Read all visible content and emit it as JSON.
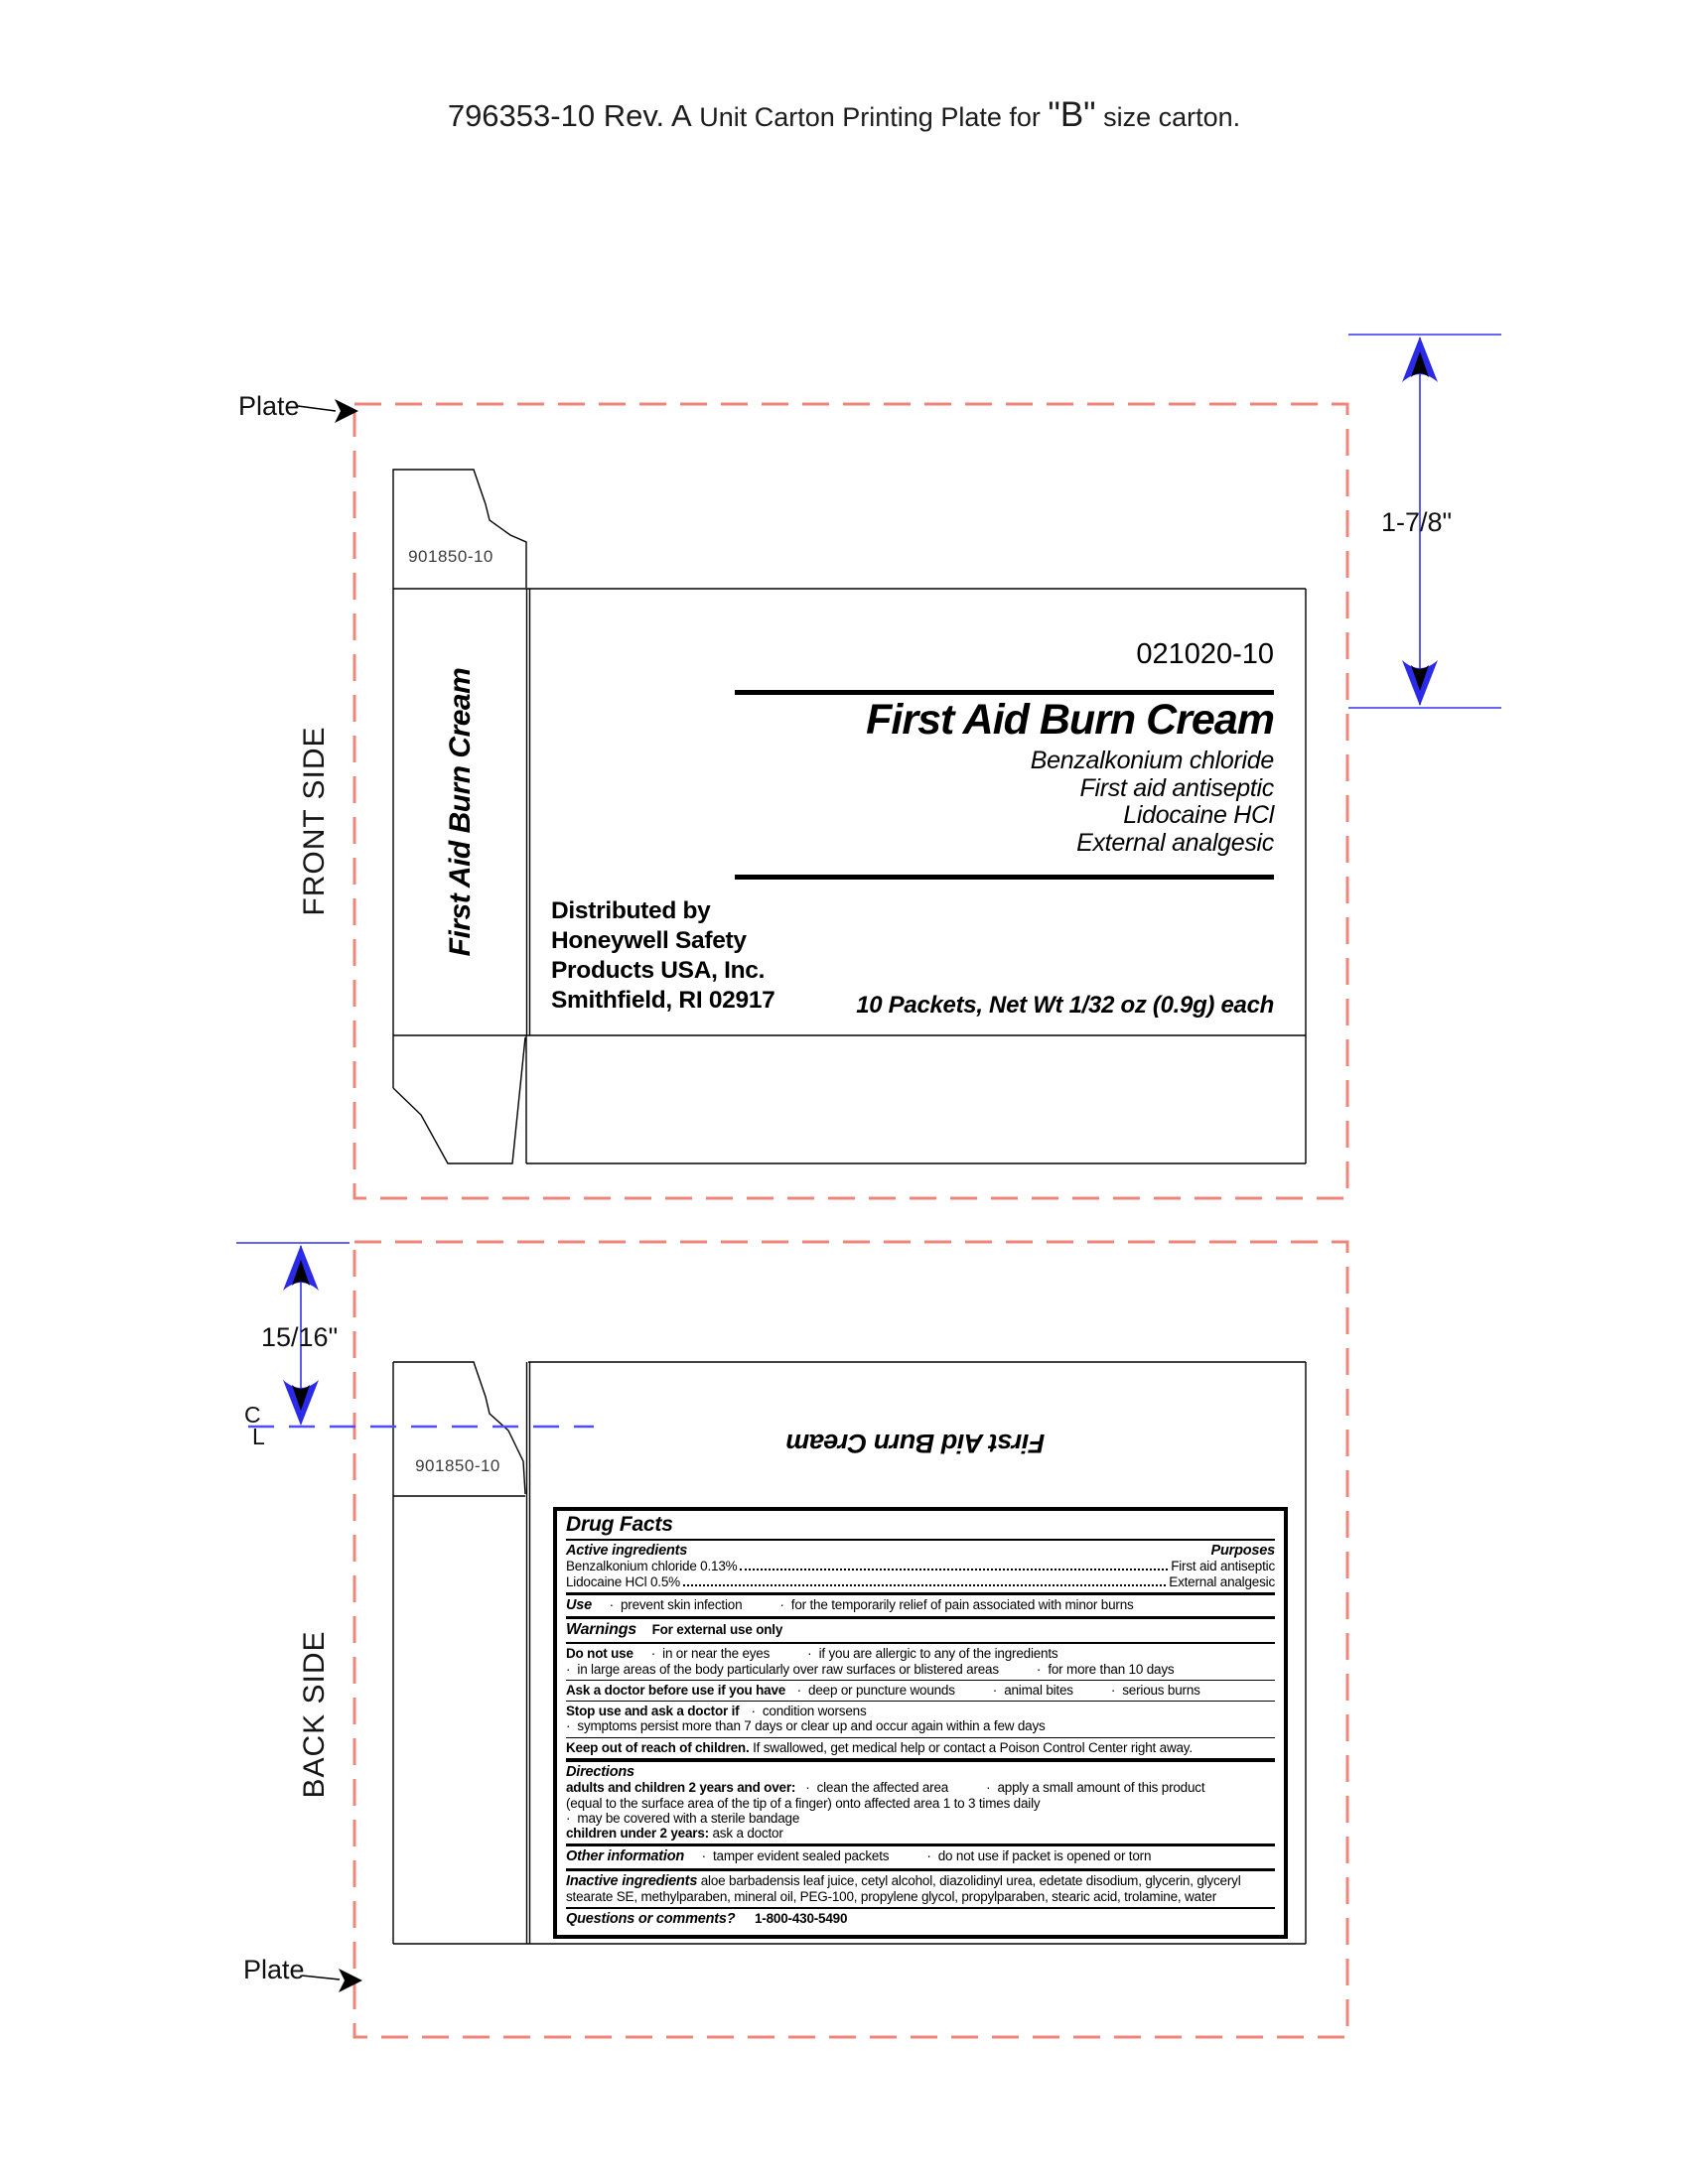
{
  "page_title": {
    "code": "796353-10 Rev. A",
    "middle": " Unit Carton Printing Plate for ",
    "emph": "\"B\"",
    "tail": " size carton."
  },
  "annotations": {
    "plate_label_top": "Plate",
    "plate_label_bottom": "Plate",
    "front_side": "FRONT SIDE",
    "back_side": "BACK SIDE",
    "centerline_c": "C",
    "centerline_l": "L",
    "dim_front_height": "1-7/8\"",
    "dim_back_offset": "15/16\"",
    "plate_dash_color": "#f08478",
    "dimension_color": "#2a2ae8",
    "centerline_color": "#4d4dff"
  },
  "front_panel": {
    "flap_code": "901850-10",
    "side_text": "First Aid Burn Cream",
    "part_number": "021020-10",
    "product_name": "First Aid Burn Cream",
    "sub_lines": [
      "Benzalkonium chloride",
      "First aid antiseptic",
      "Lidocaine HCl",
      "External analgesic"
    ],
    "distributor": [
      "Distributed by",
      "Honeywell Safety",
      "Products USA, Inc.",
      "Smithfield, RI 02917"
    ],
    "net_wt": "10 Packets, Net Wt 1/32 oz (0.9g) each"
  },
  "back_panel": {
    "flap_code": "901850-10",
    "panel_title": "First Aid Burn Cream",
    "drug_facts": {
      "header": "Drug Facts",
      "active_header": "Active ingredients",
      "purposes_header": "Purposes",
      "active1_name": "Benzalkonium chloride 0.13%",
      "active1_purpose": "First aid antiseptic",
      "active2_name": "Lidocaine HCl 0.5%",
      "active2_purpose": "External analgesic",
      "use_label": "Use",
      "use_items": [
        "prevent skin infection",
        "for the temporarily relief of pain associated with minor burns"
      ],
      "warnings_label": "Warnings",
      "warnings_sub": "For external use only",
      "do_not_use_label": "Do not use",
      "do_not_use_line1": [
        "in or near the eyes",
        "if you are allergic to any of the ingredients"
      ],
      "do_not_use_line2": [
        "in large areas of the body particularly over raw surfaces or blistered areas",
        "for more than 10 days"
      ],
      "ask_doctor_label": "Ask a doctor before use if you have",
      "ask_doctor_items": [
        "deep or puncture wounds",
        "animal bites",
        "serious burns"
      ],
      "stop_use_label": "Stop use and ask a doctor if",
      "stop_use_line1": [
        "condition worsens"
      ],
      "stop_use_line2": [
        "symptoms persist more than 7 days or clear up and occur again within a few days"
      ],
      "keep_label": "Keep out of reach of children.",
      "keep_text": " If swallowed, get medical help or contact a Poison Control Center right away.",
      "directions_label": "Directions",
      "directions_adults_label": "adults and children 2 years and over:",
      "directions_adults_items": [
        "clean the affected area",
        "apply a small amount of this product"
      ],
      "directions_line2": "(equal to the surface area of the tip of a finger) onto affected area 1 to 3 times daily",
      "directions_line3": [
        "may be covered with a sterile bandage"
      ],
      "directions_children_label": "children under 2 years:",
      "directions_children_text": " ask a doctor",
      "other_label": "Other information",
      "other_items": [
        "tamper evident sealed packets",
        "do not use if packet is opened or torn"
      ],
      "inactive_label": "Inactive ingredients",
      "inactive_text": " aloe barbadensis leaf juice, cetyl alcohol, diazolidinyl urea, edetate disodium, glycerin, glyceryl stearate SE, methylparaben, mineral oil, PEG-100, propylene glycol, propylparaben, stearic acid, trolamine, water",
      "questions_label": "Questions or comments?",
      "questions_phone": "1-800-430-5490"
    }
  }
}
